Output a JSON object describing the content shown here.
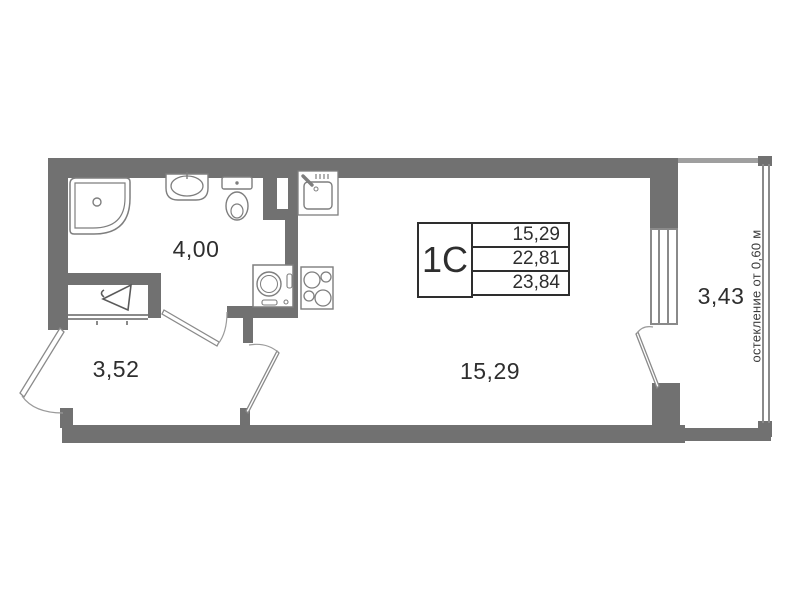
{
  "unit_card": {
    "unit_type": "1С",
    "areas": [
      "15,29",
      "22,81",
      "23,84"
    ]
  },
  "rooms": {
    "bathroom": {
      "area": "4,00"
    },
    "hallway": {
      "area": "3,52"
    },
    "living": {
      "area": "15,29"
    },
    "balcony": {
      "area": "3,43"
    }
  },
  "annotations": {
    "glazing_note": "остекление от 0,60 м"
  },
  "fixtures": [
    "shower-icon",
    "washbasin-icon",
    "toilet-icon",
    "washing-machine-icon",
    "stove-icon",
    "kitchen-sink-icon",
    "wardrobe-hanger-icon"
  ],
  "colors": {
    "wall": "#717171",
    "fixture_line": "#7e7e7e",
    "text": "#2e2e2e"
  }
}
